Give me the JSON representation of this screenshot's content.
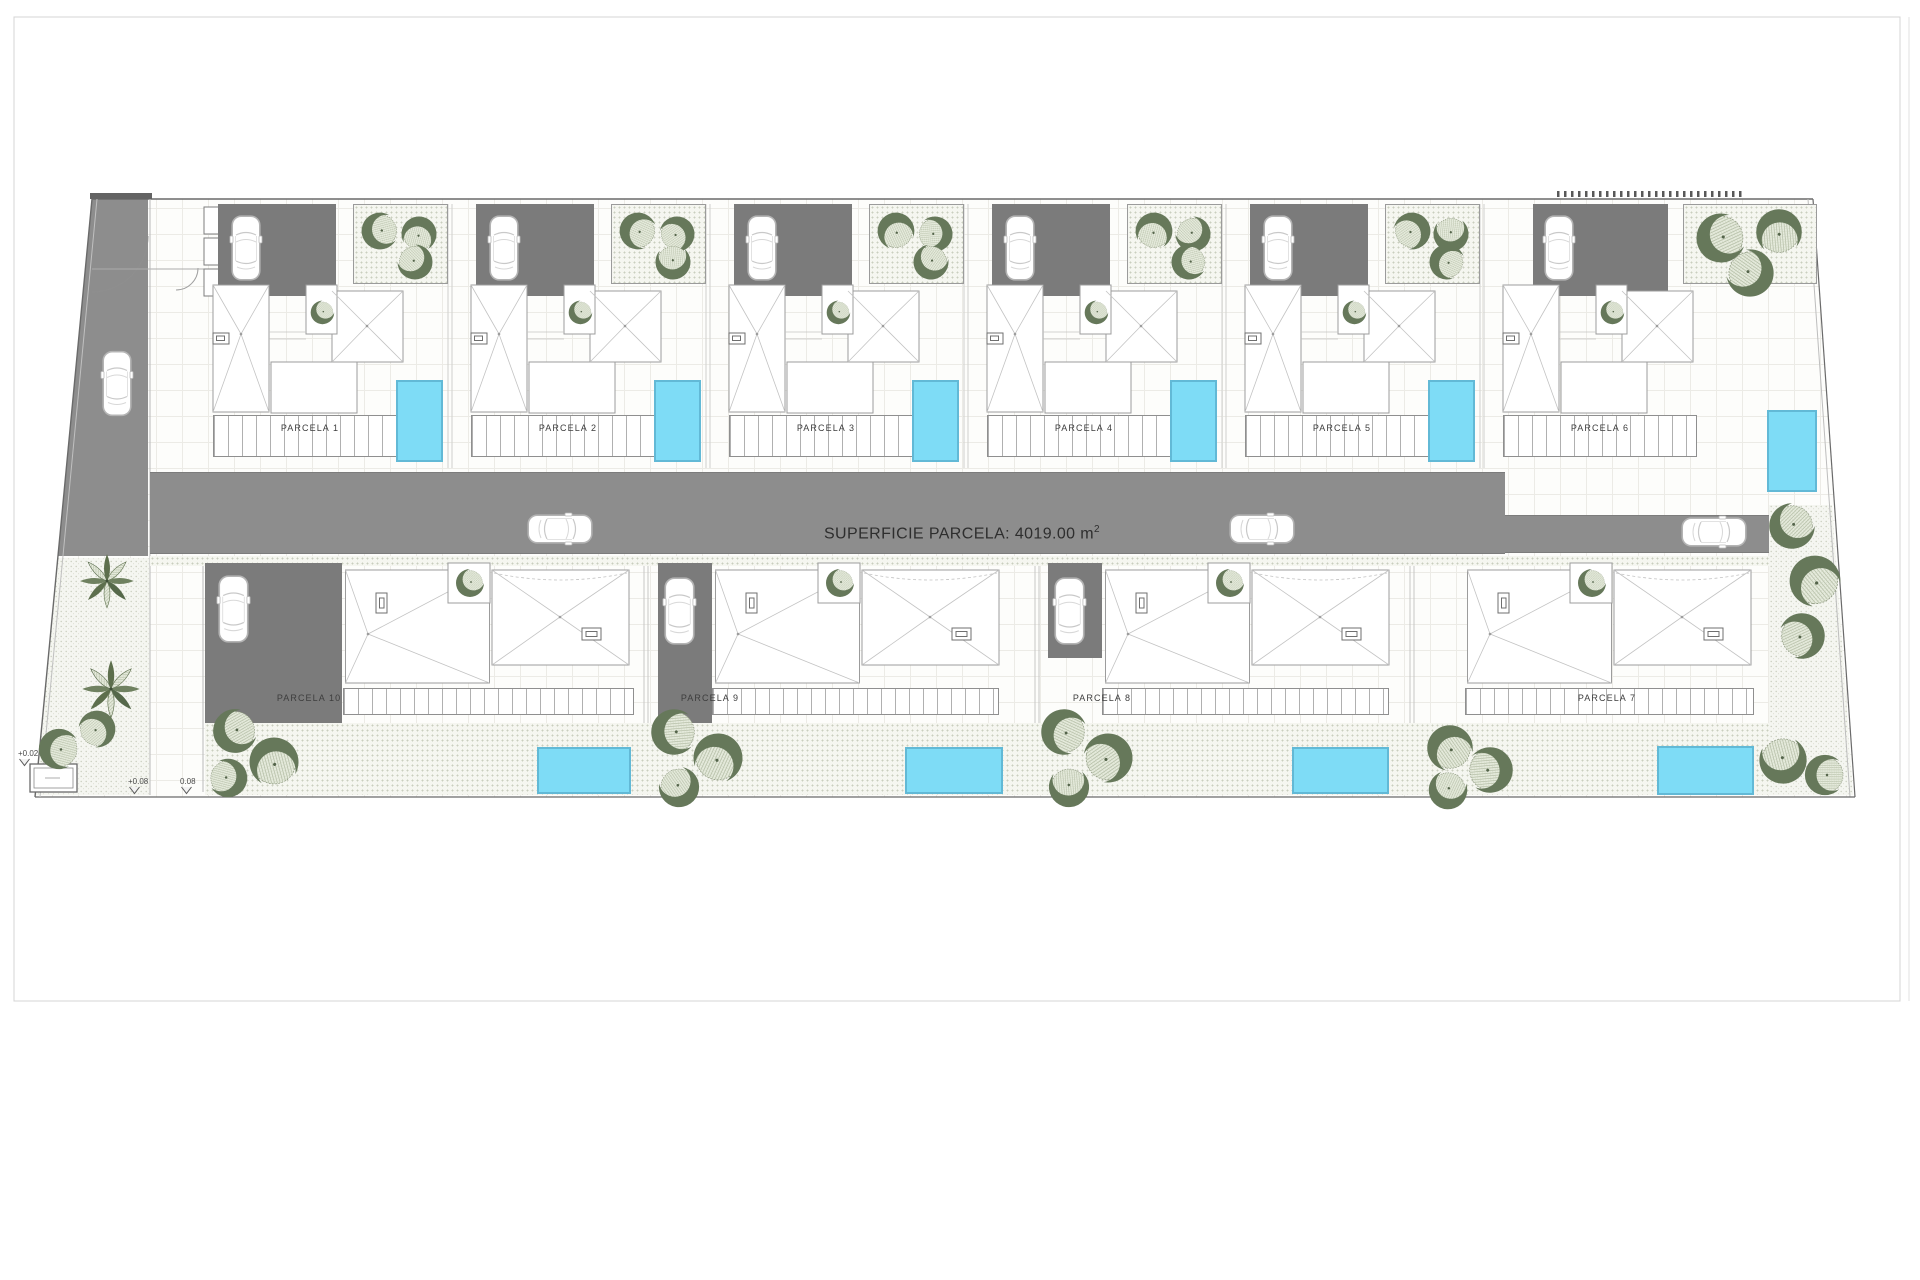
{
  "sheet": {
    "road_label_text": "SUPERFICIE PARCELA: 4019.00 m",
    "road_label_sup": "2"
  },
  "parcels": {
    "top": [
      {
        "label": "PARCELA 1"
      },
      {
        "label": "PARCELA 2"
      },
      {
        "label": "PARCELA 3"
      },
      {
        "label": "PARCELA 4"
      },
      {
        "label": "PARCELA 5"
      },
      {
        "label": "PARCELA 6"
      }
    ],
    "bottom": [
      {
        "label": "PARCELA 10"
      },
      {
        "label": "PARCELA 9"
      },
      {
        "label": "PARCELA 8"
      },
      {
        "label": "PARCELA 7"
      }
    ]
  },
  "markers": [
    {
      "label": "+0.02"
    },
    {
      "label": "+0.08"
    },
    {
      "label": "0.08"
    }
  ],
  "icons": {
    "car": "car-icon",
    "round_tree": "round-tree-icon",
    "palm": "palm-tree-icon"
  },
  "colors": {
    "road": "#8d8d8d",
    "driveway": "#7b7b7b",
    "pool_fill": "#7edcf6",
    "pool_edge": "#62b9d6",
    "tree_dark": "#66785a",
    "tree_light": "#e6ebdd",
    "boundary": "#6a6a6a",
    "roof_line": "#c3c3c3"
  }
}
